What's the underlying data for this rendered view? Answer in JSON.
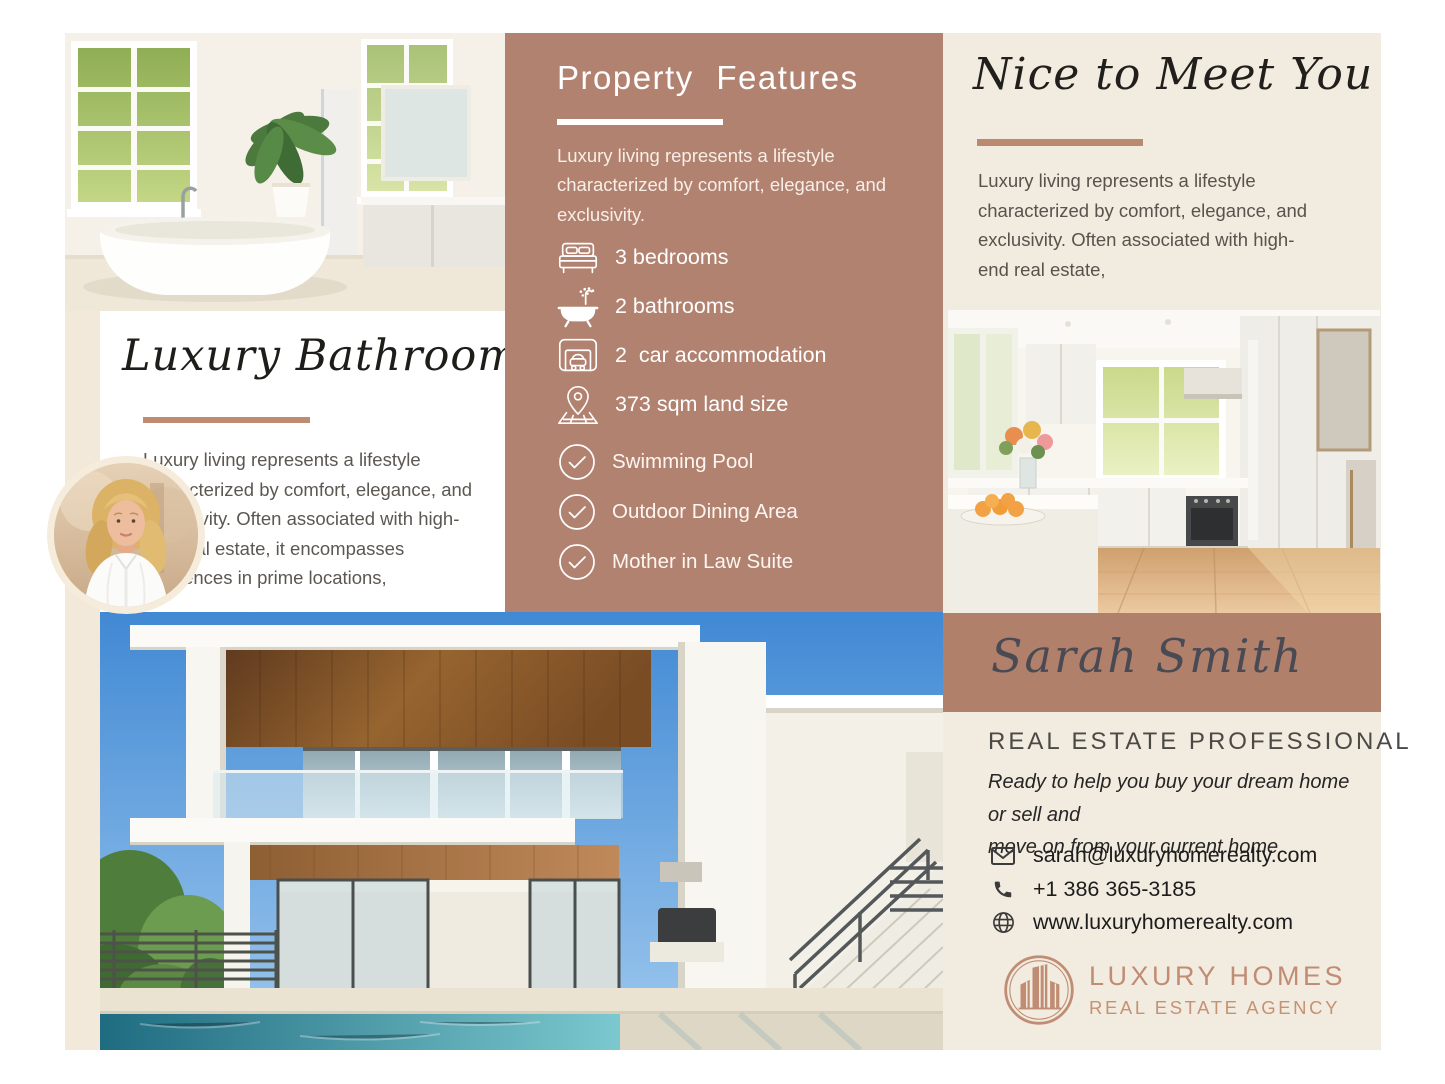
{
  "theme": {
    "panel_brown": "#b28271",
    "band_brown": "#b1806b",
    "cream": "#f2ebdf",
    "accent_rose": "#bd8c72",
    "logo_rose": "#c08d74",
    "text_gray": "#5c5751",
    "white": "#ffffff"
  },
  "bathroom_section": {
    "title": "Luxury Bathroom",
    "paragraph_lines": [
      "Luxury living represents a lifestyle",
      "characterized by comfort, elegance, and",
      "exclusivity. Often associated with high-",
      "end real estate, it encompasses",
      "residences in prime locations,"
    ]
  },
  "features_panel": {
    "title": "Property Features",
    "intro_lines": [
      "Luxury living represents a lifestyle",
      "characterized by comfort, elegance, and",
      "exclusivity."
    ],
    "items": [
      {
        "icon": "bed-icon",
        "label": "3 bedrooms"
      },
      {
        "icon": "bathtub-icon",
        "label": "2 bathrooms"
      },
      {
        "icon": "garage-icon",
        "label": "2  car accommodation"
      },
      {
        "icon": "map-pin-icon",
        "label": "373 sqm land size"
      }
    ],
    "amenities": [
      {
        "icon": "check-circle-icon",
        "label": "Swimming Pool"
      },
      {
        "icon": "check-circle-icon",
        "label": "Outdoor Dining Area"
      },
      {
        "icon": "check-circle-icon",
        "label": "Mother in Law Suite"
      }
    ]
  },
  "about_section": {
    "title": "Nice to Meet You",
    "paragraph_lines": [
      "Luxury living represents a lifestyle",
      "characterized by comfort, elegance, and",
      "exclusivity. Often associated with high-",
      "end real estate,"
    ],
    "agent_name": "Sarah Smith",
    "agent_role": "REAL ESTATE PROFESSIONAL",
    "tagline_lines": [
      "Ready to help you buy your dream home or sell and",
      "move on from your current home"
    ],
    "contacts": [
      {
        "icon": "email-icon",
        "value": "sarah@luxuryhomerealty.com"
      },
      {
        "icon": "phone-icon",
        "value": "+1 386 365-3185"
      },
      {
        "icon": "globe-icon",
        "value": "www.luxuryhomerealty.com"
      }
    ],
    "logo": {
      "name": "LUXURY HOMES",
      "subtitle": "REAL ESTATE AGENCY"
    }
  }
}
